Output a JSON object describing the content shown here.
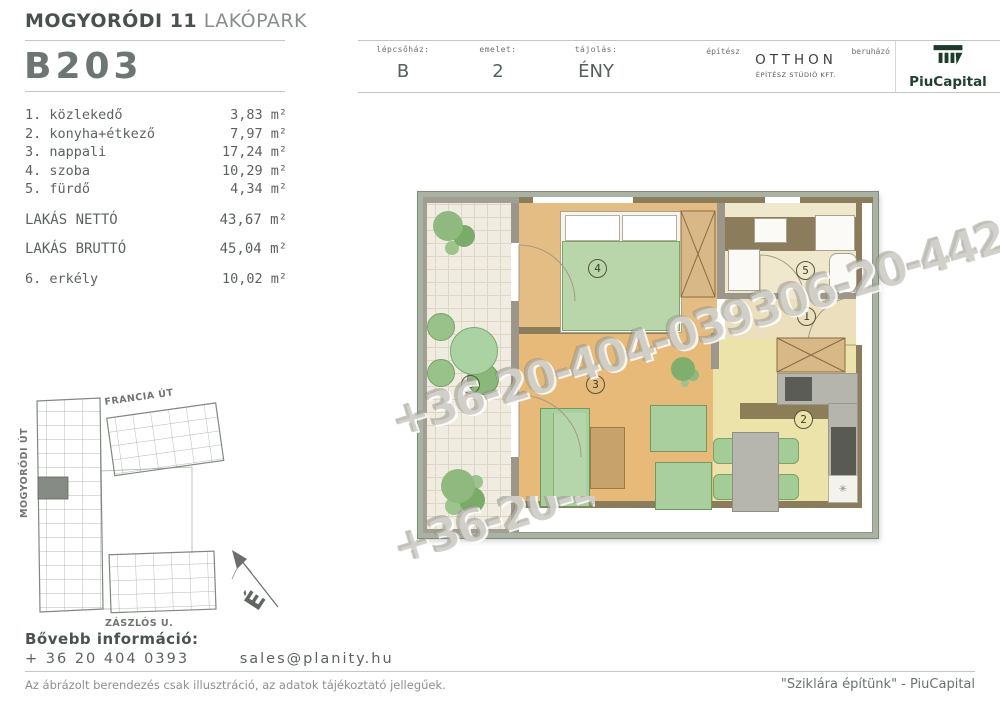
{
  "header": {
    "project_title_bold": "MOGYORÓDI 11",
    "project_title_light": "LAKÓPARK",
    "unit_id": "B203",
    "meta_cells": [
      {
        "label": "lépcsőház:",
        "value": "B"
      },
      {
        "label": "emelet:",
        "value": "2"
      },
      {
        "label": "tájolás:",
        "value": "ÉNY"
      }
    ],
    "architect_label": "építész",
    "architect_line1": "OTTHON",
    "architect_line2": "ÉPÍTÉSZ STÚDIÓ KFT.",
    "developer_label": "beruházó",
    "developer_name": "PiuCapital"
  },
  "room_list": {
    "rooms": [
      {
        "name": "1. közlekedő",
        "area": "3,83 m²"
      },
      {
        "name": "2. konyha+étkező",
        "area": "7,97 m²"
      },
      {
        "name": "3. nappali",
        "area": "17,24 m²"
      },
      {
        "name": "4. szoba",
        "area": "10,29 m²"
      },
      {
        "name": "5. fürdő",
        "area": "4,34 m²"
      }
    ],
    "totals": [
      {
        "name": "LAKÁS NETTÓ",
        "area": "43,67 m²"
      },
      {
        "name": "LAKÁS BRUTTÓ",
        "area": "45,04 m²"
      }
    ],
    "extra": {
      "name": "6. erkély",
      "area": "10,02 m²"
    }
  },
  "floorplan": {
    "watermark": "+36-20-404-039306-20-442-2",
    "labels": {
      "hallway": "1",
      "kitchen": "2",
      "living": "3",
      "bedroom": "4",
      "bathroom": "5",
      "balcony": "6"
    },
    "stove_symbol": "✳"
  },
  "sitemap": {
    "street_top": "FRANCIA ÚT",
    "street_left": "MOGYORÓDI ÚT",
    "street_bottom": "ZÁSZLÓS U.",
    "north_label": "É"
  },
  "contact": {
    "heading": "Bővebb információ:",
    "phone": "+ 36 20 404 0393",
    "email": "sales@planity.hu"
  },
  "footer": {
    "disclaimer": "Az ábrázolt berendezés csak illusztráció, az adatok tájékoztató jellegűek.",
    "slogan": "\"Sziklára építünk\" - PiuCapital"
  }
}
